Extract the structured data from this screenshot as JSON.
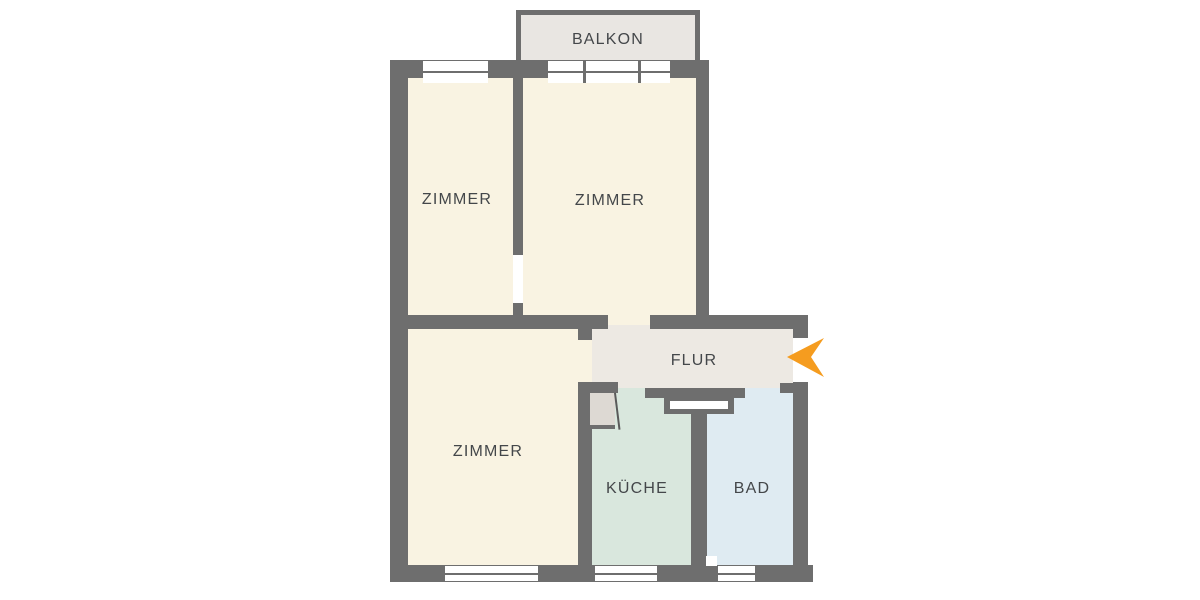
{
  "plan_title": "apartment-floor-plan",
  "colors": {
    "wall": "#6E6E6E",
    "room": "#F9F3E2",
    "balcony": "#E9E6E2",
    "flur": "#EDE9E3",
    "kueche": "#D9E7DD",
    "bad": "#DFEBF2",
    "doorleaf": "#DDD9D3",
    "arrow": "#F59C1F",
    "text": "#44474A",
    "window": "#FFFFFF"
  },
  "rooms": {
    "balkon": {
      "label": "BALKON"
    },
    "zimmer_tl": {
      "label": "ZIMMER"
    },
    "zimmer_tr": {
      "label": "ZIMMER"
    },
    "zimmer_b": {
      "label": "ZIMMER"
    },
    "flur": {
      "label": "FLUR"
    },
    "kueche": {
      "label": "KÜCHE"
    },
    "bad": {
      "label": "BAD"
    }
  },
  "entrance": {
    "icon": "entrance-arrow",
    "direction": "left"
  }
}
